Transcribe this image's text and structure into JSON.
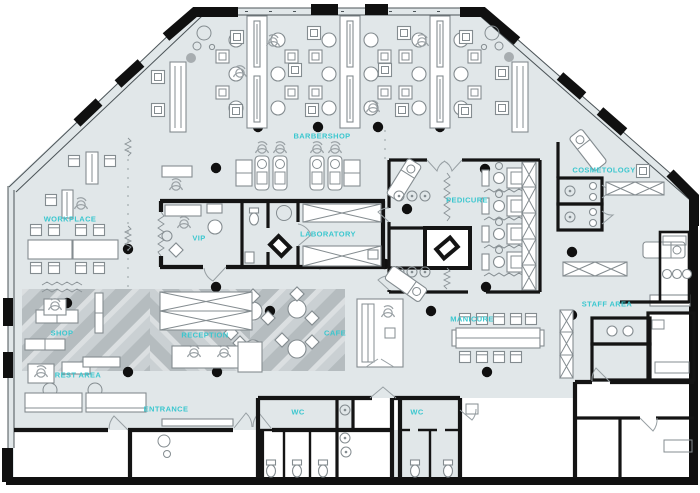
{
  "plan": {
    "title": "Beauty salon floor plan",
    "colors": {
      "floor": "#e1e7e9",
      "wall": "#141414",
      "label_accent": "#3bc7cf",
      "pattern_dark": "#b3babd",
      "pattern_base": "#c9cfd2",
      "pattern_light": "#dbdfe1",
      "furniture_stroke": "#848c90"
    },
    "rooms": [
      {
        "id": "barbershop",
        "label": "BARBERSHOP"
      },
      {
        "id": "workplace",
        "label": "WORKPLACE"
      },
      {
        "id": "vip",
        "label": "VIP"
      },
      {
        "id": "laboratory",
        "label": "LABORATORY"
      },
      {
        "id": "pedicure",
        "label": "PEDICURE"
      },
      {
        "id": "cosmetology",
        "label": "COSMETOLOGY"
      },
      {
        "id": "staff-area",
        "label": "STAFF AREA"
      },
      {
        "id": "manicure",
        "label": "MANICURE"
      },
      {
        "id": "cafe",
        "label": "CAFE"
      },
      {
        "id": "reception",
        "label": "RECEPTION"
      },
      {
        "id": "shop",
        "label": "SHOP"
      },
      {
        "id": "rest-area",
        "label": "REST AREA"
      },
      {
        "id": "entrance",
        "label": "ENTRANCE"
      },
      {
        "id": "wc-left",
        "label": "WC"
      },
      {
        "id": "wc-right",
        "label": "WC"
      }
    ]
  }
}
